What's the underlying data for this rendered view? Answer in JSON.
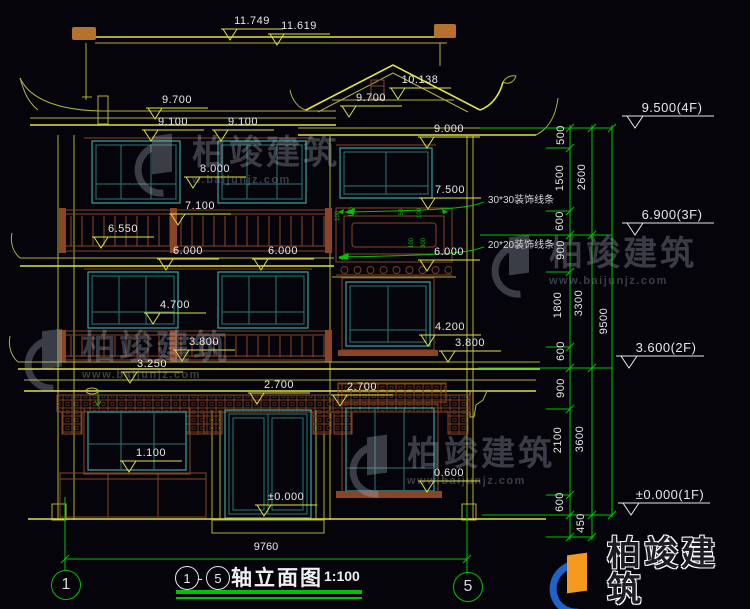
{
  "watermark": {
    "name": "柏竣建筑",
    "url": "www.baijunjz.com",
    "url_short": "w.baijunjz.com"
  },
  "title_block": {
    "axis_from": "1",
    "sep": "-",
    "axis_to": "5",
    "title": "轴立面图",
    "scale": "1:100"
  },
  "axis_bubbles": {
    "left": "1",
    "right": "5"
  },
  "overall_dim": "9760",
  "levels": {
    "f4": "9.500(4F)",
    "f3": "6.900(3F)",
    "f2": "3.600(2F)",
    "f1": "±0.000(1F)"
  },
  "chain_dims": {
    "c500": "500",
    "c1500": "1500",
    "c2600": "2600",
    "c600a": "600",
    "c900a": "900",
    "c1800": "1800",
    "c3300": "3300",
    "c9500": "9500",
    "c600b": "600",
    "c900b": "900",
    "c2100": "2100",
    "c3600": "3600",
    "c600c": "600",
    "c450": "450"
  },
  "elev_dims": {
    "d11749": "11.749",
    "d11619": "11.619",
    "d10138": "10.138",
    "d9700a": "9.700",
    "d9700b": "9.700",
    "d9100a": "9.100",
    "d9100b": "9.100",
    "d9000": "9.000",
    "d8000": "8.000",
    "d7500": "7.500",
    "d7100": "7.100",
    "d6550": "6.550",
    "d6000a": "6.000",
    "d6000b": "6.000",
    "d6000c": "6.000",
    "d4700": "4.700",
    "d4200": "4.200",
    "d3800a": "3.800",
    "d3800b": "3.800",
    "d3250": "3.250",
    "d2700a": "2.700",
    "d2700b": "2.700",
    "d1100": "1.100",
    "d0600": "0.600",
    "dzero": "±0.000"
  },
  "notes": {
    "molding3030": "30*30装饰线条",
    "molding2020": "20*20装饰线条"
  },
  "detail_dims": {
    "v1": "100",
    "v2": "100",
    "v3": "50",
    "v4": "100",
    "v5": "100",
    "v6": "300"
  }
}
